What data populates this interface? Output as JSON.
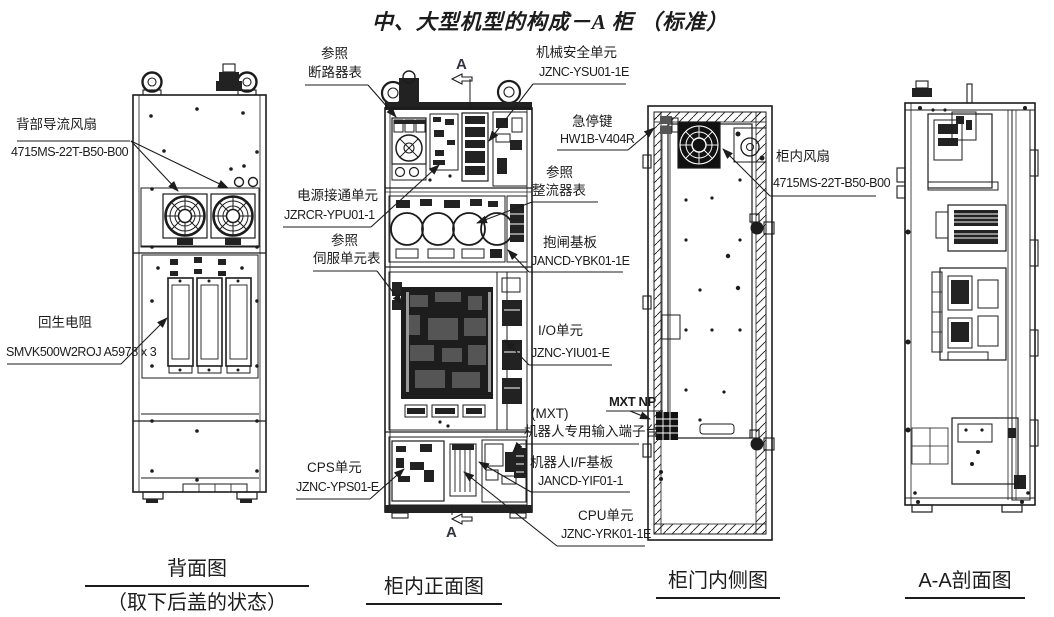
{
  "title": "中、大型机型的构成－A 柜 （标准）",
  "colors": {
    "ink": "#1c1c1c",
    "paper": "#ffffff"
  },
  "section_markers": {
    "top": "A",
    "bottom": "A"
  },
  "views": {
    "rear": {
      "caption": "背面图",
      "caption_note": "（取下后盖的状态）"
    },
    "front": {
      "caption": "柜内正面图"
    },
    "door": {
      "caption": "柜门内侧图"
    },
    "section": {
      "caption": "A-A剖面图"
    }
  },
  "labels": {
    "rear_fan": {
      "name": "背部导流风扇",
      "part": "4715MS-22T-B50-B00"
    },
    "regen_resistor": {
      "name": "回生电阻",
      "part": "SMVK500W2ROJ A5978 x 3"
    },
    "breaker_ref": {
      "line1": "参照",
      "line2": "断路器表"
    },
    "power_on_unit": {
      "name": "电源接通单元",
      "part": "JZRCR-YPU01-1"
    },
    "servo_ref": {
      "line1": "参照",
      "line2": "伺服单元表"
    },
    "cps_unit": {
      "name": "CPS单元",
      "part": "JZNC-YPS01-E"
    },
    "safety_unit": {
      "name": "机械安全单元",
      "part": "JZNC-YSU01-1E"
    },
    "estop_key": {
      "name": "急停键",
      "part": "HW1B-V404R"
    },
    "rectifier_ref": {
      "line1": "参照",
      "line2": "整流器表"
    },
    "brake_board": {
      "name": "抱闸基板",
      "part": "JANCD-YBK01-1E"
    },
    "io_unit": {
      "name": "I/O单元",
      "part": "JZNC-YIU01-E"
    },
    "mxt_np": {
      "name": "MXT NP"
    },
    "mxt_terminal": {
      "line1": "(MXT)",
      "line2": "机器人专用输入端子台"
    },
    "robot_if_board": {
      "name": "机器人I/F基板",
      "part": "JANCD-YIF01-1"
    },
    "cpu_unit": {
      "name": "CPU单元",
      "part": "JZNC-YRK01-1E"
    },
    "cabinet_fan": {
      "name": "柜内风扇",
      "part": "4715MS-22T-B50-B00"
    }
  }
}
